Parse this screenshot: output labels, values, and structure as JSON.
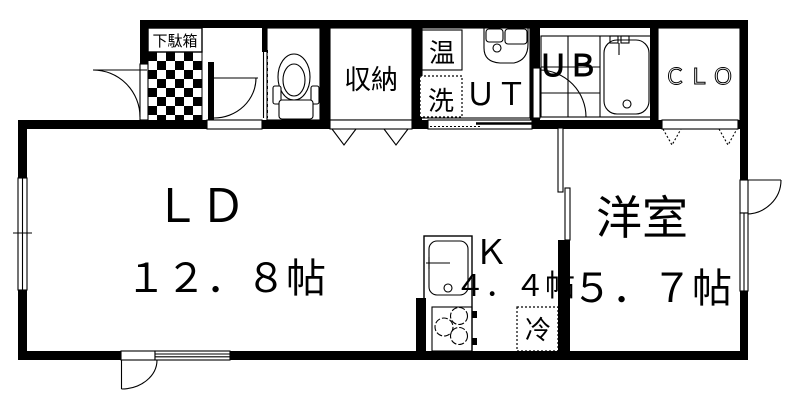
{
  "floorplan": {
    "title": "apartment-floorplan-1ldk",
    "colors": {
      "line": "#000000",
      "background": "#ffffff"
    },
    "rooms": {
      "entrance": {
        "shoe_cabinet_label": "下駄箱"
      },
      "storage": {
        "label": "収納"
      },
      "utility": {
        "label": "ＵＴ",
        "water_heater_label": "温",
        "washer_label": "洗"
      },
      "unit_bath": {
        "label": "ＵＢ"
      },
      "closet": {
        "label": "ＣＬＯ"
      },
      "living_dining": {
        "label": "ＬＤ",
        "size": "１２．８帖"
      },
      "kitchen": {
        "label": "Ｋ",
        "size": "４．４帖",
        "fridge_label": "冷"
      },
      "western_room": {
        "label": "洋室",
        "size": "５．７帖"
      }
    }
  }
}
